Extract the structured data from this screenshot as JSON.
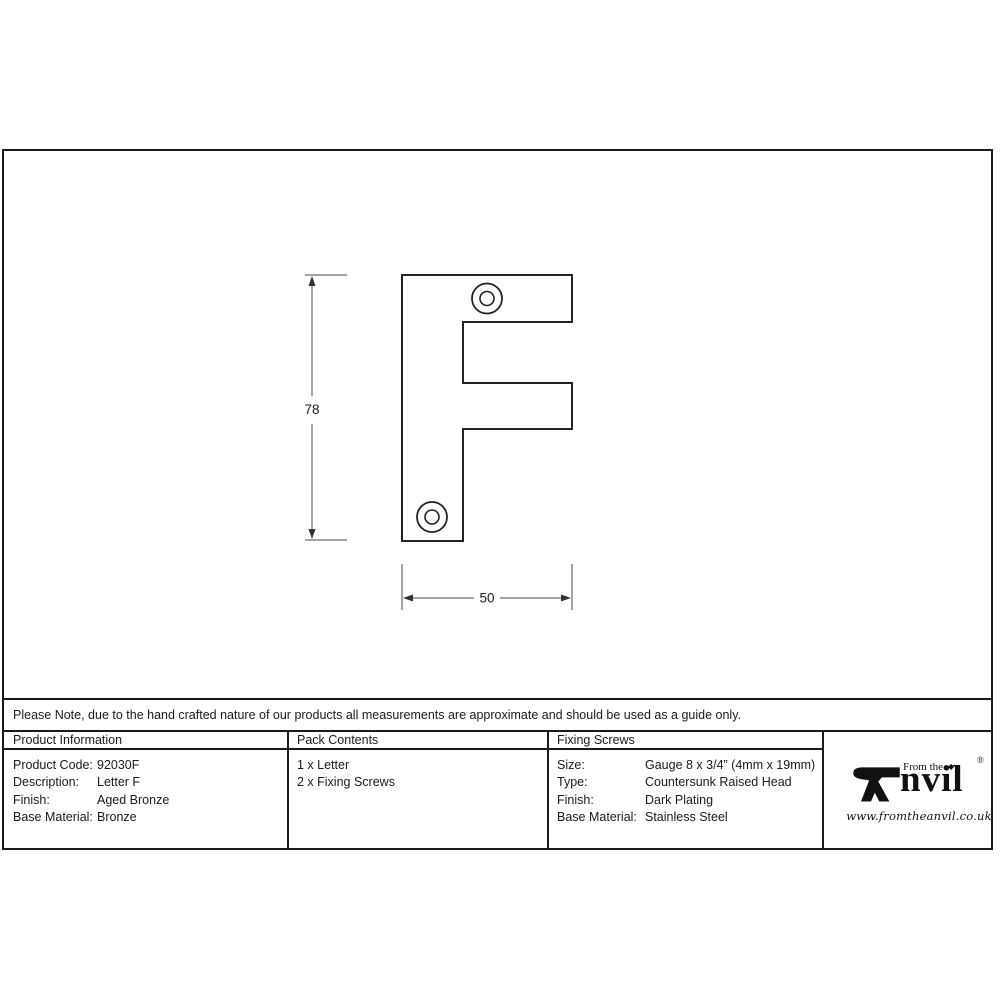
{
  "notice": {
    "text": "Please Note, due to the hand crafted nature of our products all measurements are approximate and should be used as a guide only."
  },
  "drawing": {
    "letter": "F",
    "dim_height": "78",
    "dim_width": "50"
  },
  "table": {
    "columns": [
      {
        "header": "Product Information",
        "rows": [
          {
            "label": "Product Code:",
            "value": "92030F"
          },
          {
            "label": "Description:",
            "value": "Letter F"
          },
          {
            "label": "Finish:",
            "value": "Aged Bronze"
          },
          {
            "label": "Base Material:",
            "value": "Bronze"
          }
        ]
      },
      {
        "header": "Pack Contents",
        "items": [
          "1 x Letter",
          "2 x Fixing Screws"
        ]
      },
      {
        "header": "Fixing Screws",
        "rows": [
          {
            "label": "Size:",
            "value": "Gauge 8 x 3/4” (4mm x 19mm)"
          },
          {
            "label": "Type:",
            "value": "Countersunk Raised Head"
          },
          {
            "label": "Finish:",
            "value": "Dark Plating"
          },
          {
            "label": "Base Material:",
            "value": "Stainless Steel"
          }
        ]
      }
    ]
  },
  "logo": {
    "from_the": "From the",
    "diamond": "◆",
    "brand_rest": "nvil",
    "registered": "®",
    "url": "www.fromtheanvil.co.uk"
  }
}
